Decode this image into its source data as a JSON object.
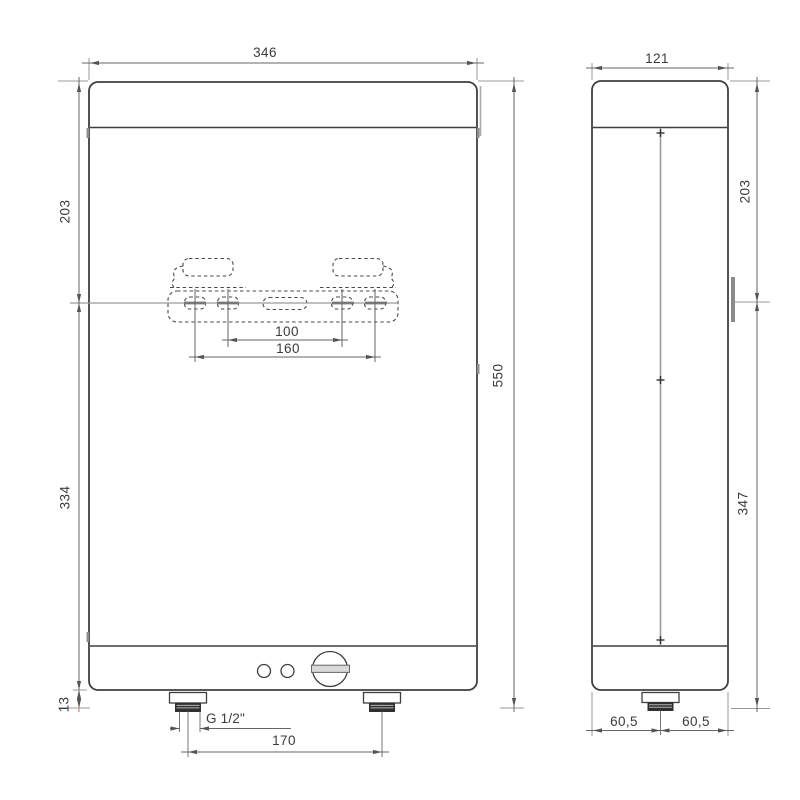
{
  "drawing": {
    "title": "water-heater-dimension-drawing",
    "front": {
      "width": "346",
      "upper_height": "203",
      "lower_height": "334",
      "bottom_clearance": "13",
      "total_height": "550",
      "bracket_inner_spacing": "100",
      "bracket_outer_spacing": "160",
      "pipe_thread": "G 1/2\"",
      "pipe_spacing": "170"
    },
    "side": {
      "depth": "121",
      "upper_height": "203",
      "lower_height": "347",
      "pipe_offset_left": "60,5",
      "pipe_offset_right": "60,5"
    },
    "colors": {
      "object_line": "#3f3f3f",
      "dimension_line": "#666666",
      "extension_line": "#999999",
      "highlight_dimension": "#d4908f",
      "background": "#ffffff"
    }
  }
}
